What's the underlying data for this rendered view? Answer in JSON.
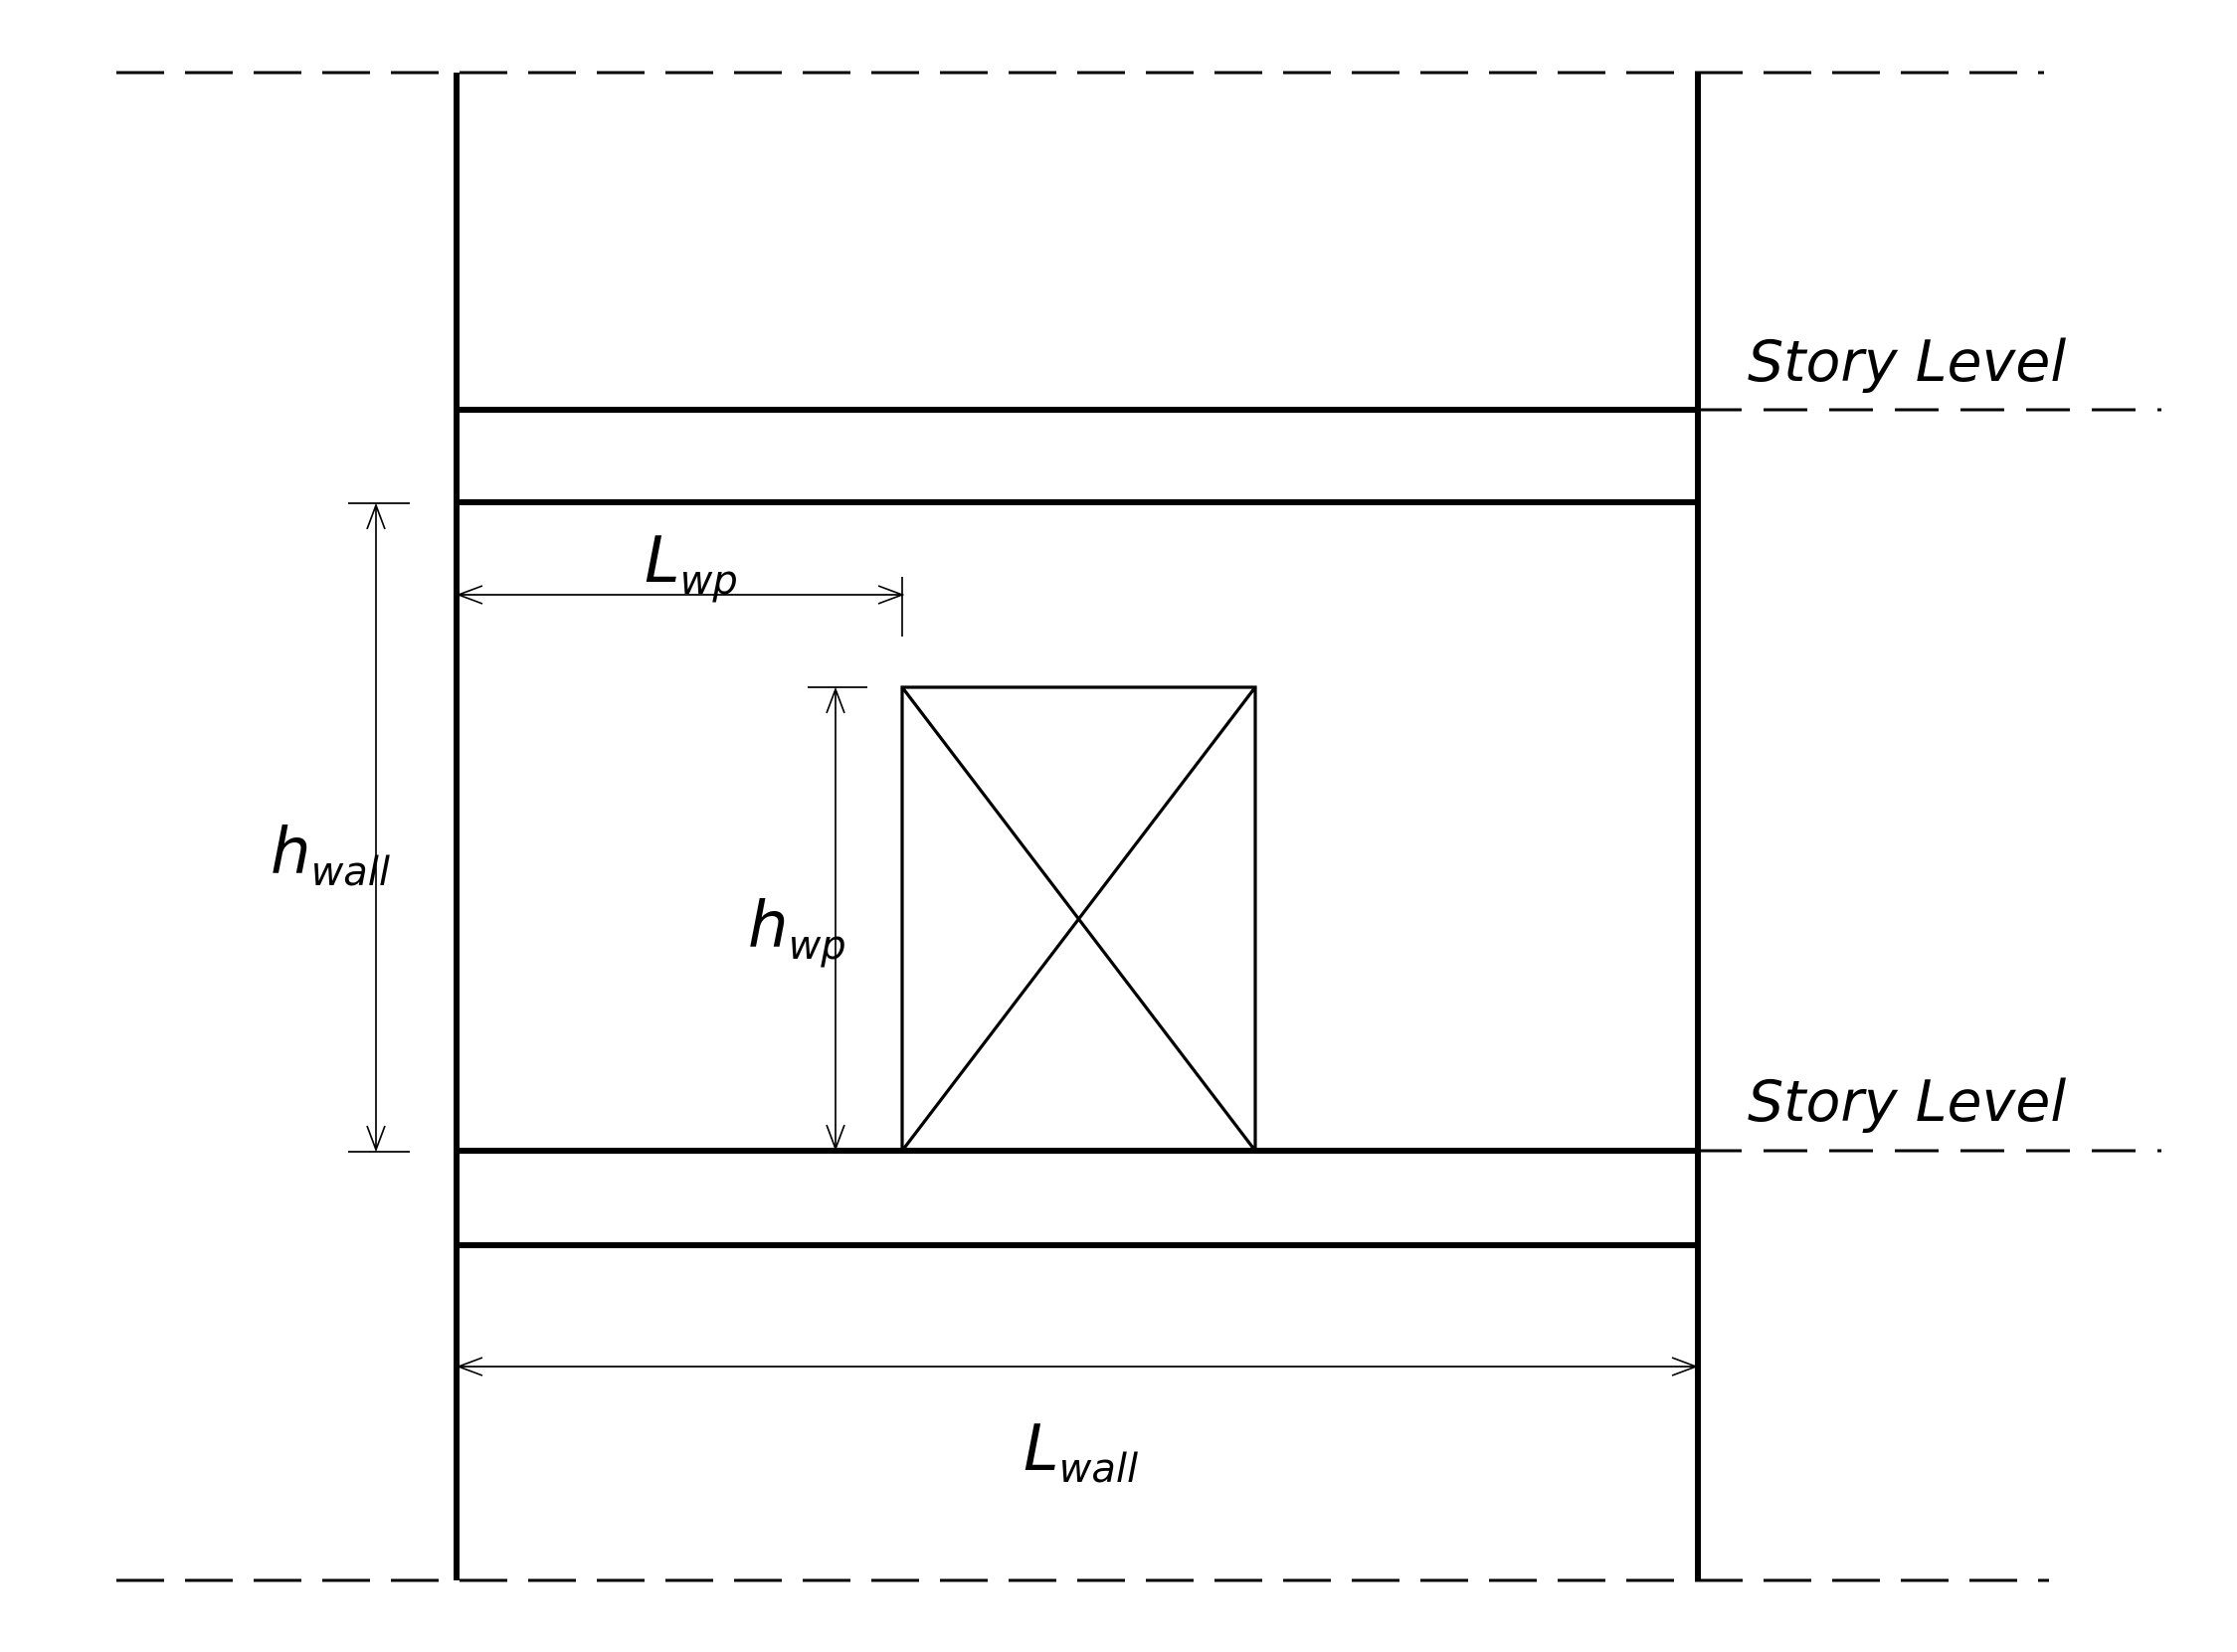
{
  "diagram": {
    "story_levels": {
      "upper": "Story Level",
      "lower": "Story Level"
    },
    "dimensions": {
      "wall_pier_length": {
        "symbol": "L",
        "subscript": "wp"
      },
      "wall_height": {
        "symbol": "h",
        "subscript": "wall"
      },
      "wall_pier_height": {
        "symbol": "h",
        "subscript": "wp"
      },
      "wall_length": {
        "symbol": "L",
        "subscript": "wall"
      }
    },
    "colors": {
      "line": "#000000",
      "background": "#ffffff"
    }
  }
}
